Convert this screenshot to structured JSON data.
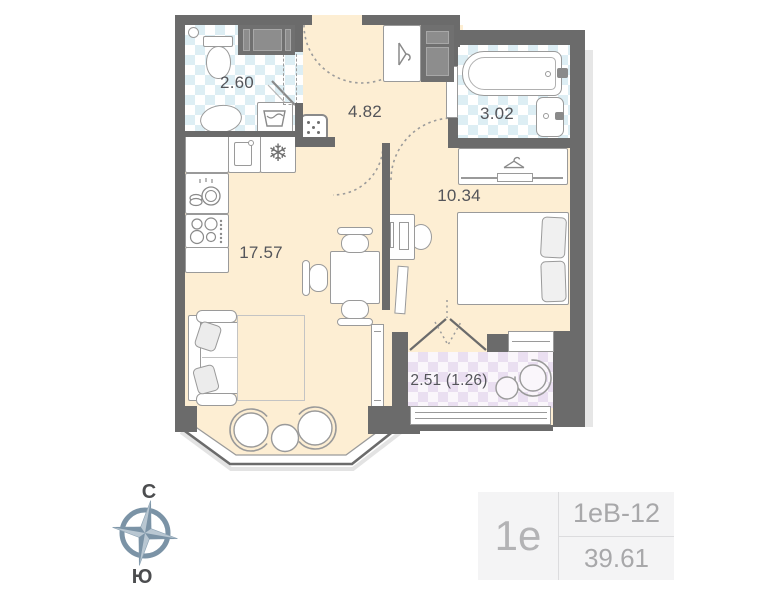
{
  "rooms": {
    "wc": {
      "area": "2.60"
    },
    "hallway": {
      "area": "4.82"
    },
    "bathroom": {
      "area": "3.02"
    },
    "bedroom": {
      "area": "10.34"
    },
    "living_kitchen": {
      "area": "17.57"
    },
    "balcony": {
      "area": "2.51 (1.26)"
    }
  },
  "compass": {
    "north_label": "С",
    "south_label": "Ю"
  },
  "info_card": {
    "plan_type": "1е",
    "unit_code": "1еВ-12",
    "total_area": "39.61"
  },
  "icons": {
    "fridge_snowflake": "❄"
  },
  "colors": {
    "wall": "#6b6b6b",
    "floor": "#fdeed3",
    "wet_room_tile": "#ddeef4",
    "balcony_tile": "#eadff1",
    "compass_accent": "#7b93a6",
    "furniture_stroke": "#9a9a9a",
    "label_text": "#54555a"
  }
}
